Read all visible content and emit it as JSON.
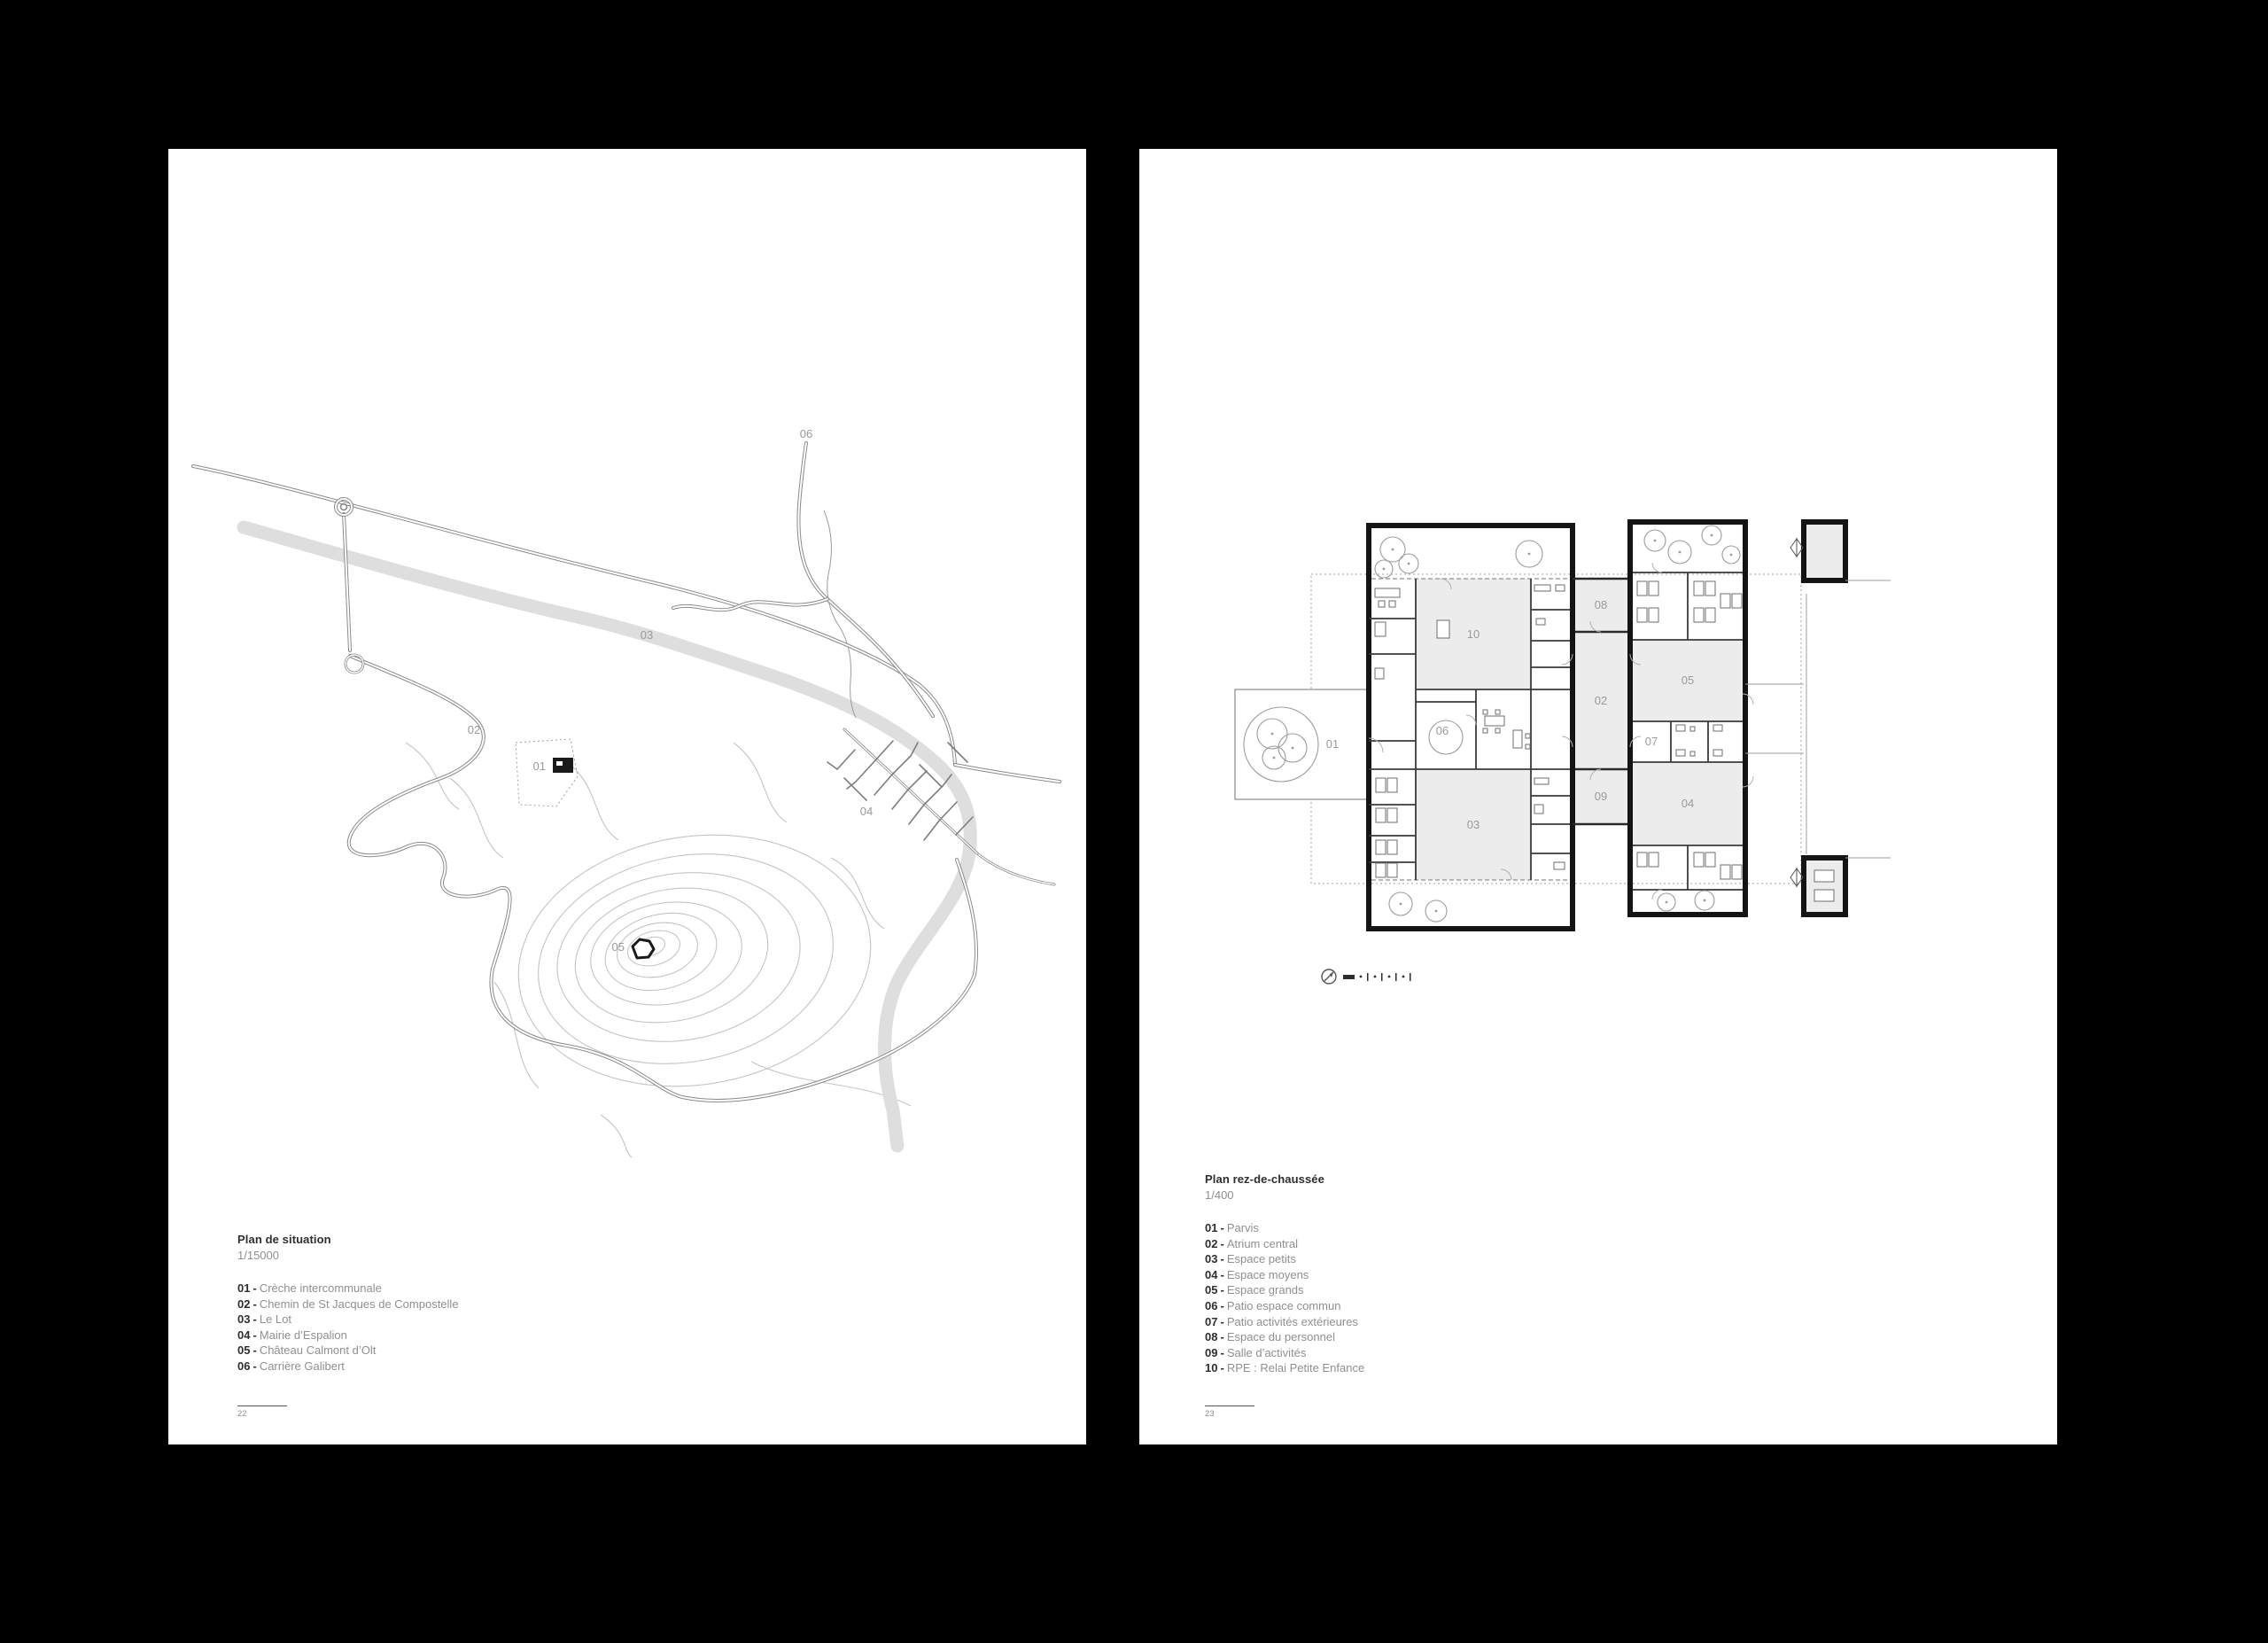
{
  "colors": {
    "canvas_bg": "#000000",
    "page_bg": "#ffffff",
    "ink": "#2e2e2e",
    "muted": "#8f8f8f",
    "wall": "#141414",
    "room_fill": "#ececec",
    "river": "#dedede",
    "contour": "#c4c4c4"
  },
  "pages": [
    {
      "title": "Plan de situation",
      "scale_label": "1/15000",
      "separator": "-",
      "legend": [
        {
          "num": "01",
          "label": "Crèche intercommunale"
        },
        {
          "num": "02",
          "label": "Chemin de St Jacques de Compostelle"
        },
        {
          "num": "03",
          "label": "Le Lot"
        },
        {
          "num": "04",
          "label": "Mairie d’Espalion"
        },
        {
          "num": "05",
          "label": "Château Calmont d’Olt"
        },
        {
          "num": "06",
          "label": "Carrière Galibert"
        }
      ],
      "map_labels": {
        "l01": "01",
        "l02": "02",
        "l03": "03",
        "l04": "04",
        "l05": "05",
        "l06": "06"
      },
      "page_number": "22"
    },
    {
      "title": "Plan rez-de-chaussée",
      "scale_label": "1/400",
      "separator": "-",
      "legend": [
        {
          "num": "01",
          "label": "Parvis"
        },
        {
          "num": "02",
          "label": "Atrium central"
        },
        {
          "num": "03",
          "label": "Espace petits"
        },
        {
          "num": "04",
          "label": "Espace moyens"
        },
        {
          "num": "05",
          "label": "Espace grands"
        },
        {
          "num": "06",
          "label": "Patio espace commun"
        },
        {
          "num": "07",
          "label": "Patio activités extérieures"
        },
        {
          "num": "08",
          "label": "Espace du personnel"
        },
        {
          "num": "09",
          "label": "Salle d’activités"
        },
        {
          "num": "10",
          "label": "RPE : Relai Petite Enfance"
        }
      ],
      "plan_labels": {
        "r01": "01",
        "r02": "02",
        "r03": "03",
        "r04": "04",
        "r05": "05",
        "r06": "06",
        "r07": "07",
        "r08": "08",
        "r09": "09",
        "r10": "10"
      },
      "page_number": "23"
    }
  ]
}
